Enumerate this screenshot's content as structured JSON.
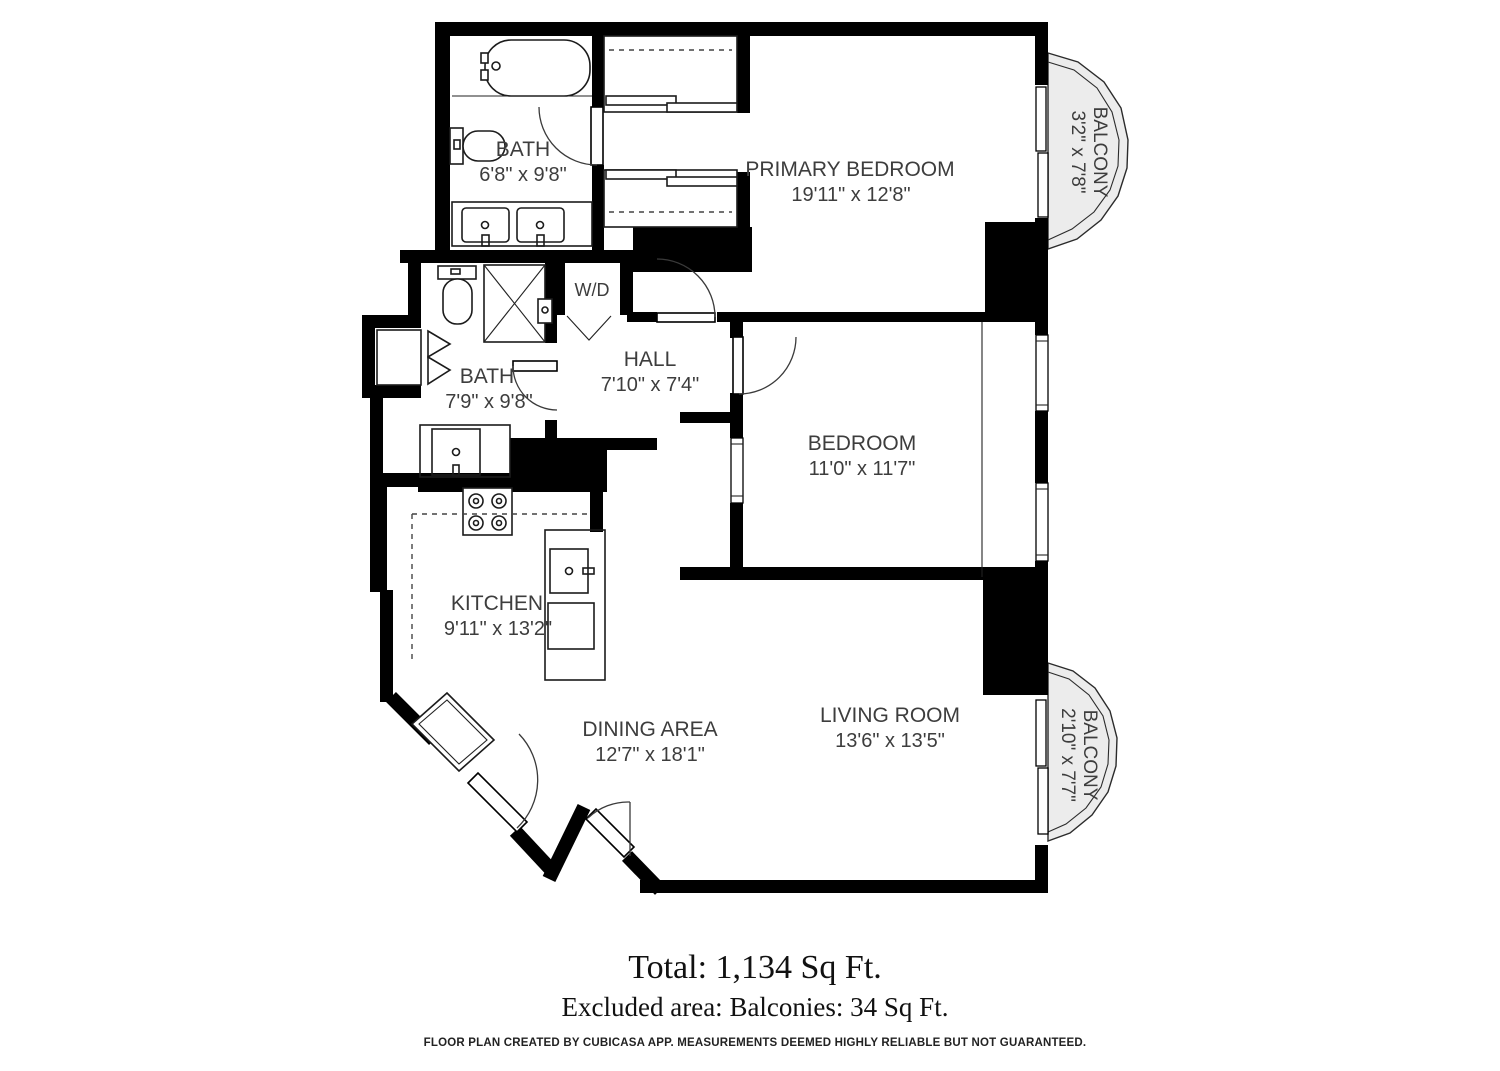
{
  "rooms": {
    "bath_top": {
      "name": "BATH",
      "dims": "6'8\" x 9'8\""
    },
    "primary_bedroom": {
      "name": "PRIMARY BEDROOM",
      "dims": "19'11\" x 12'8\""
    },
    "balcony_top": {
      "name": "BALCONY",
      "dims": "3'2\" x 7'8\""
    },
    "bath_mid": {
      "name": "BATH",
      "dims": "7'9\" x 9'8\""
    },
    "wd_closet": {
      "name": "W/D"
    },
    "hall": {
      "name": "HALL",
      "dims": "7'10\" x 7'4\""
    },
    "bedroom": {
      "name": "BEDROOM",
      "dims": "11'0\" x 11'7\""
    },
    "kitchen": {
      "name": "KITCHEN",
      "dims": "9'11\" x 13'2\""
    },
    "dining": {
      "name": "DINING AREA",
      "dims": "12'7\" x 18'1\""
    },
    "living": {
      "name": "LIVING ROOM",
      "dims": "13'6\" x 13'5\""
    },
    "balcony_bottom": {
      "name": "BALCONY",
      "dims": "2'10\" x 7'7\""
    }
  },
  "summary": {
    "total": "Total: 1,134 Sq Ft.",
    "excluded": "Excluded area: Balconies: 34 Sq Ft."
  },
  "footer": "FLOOR PLAN CREATED BY CUBICASA APP. MEASUREMENTS DEEMED HIGHLY RELIABLE BUT NOT GUARANTEED.",
  "colors": {
    "wall": "#000000",
    "balcony_fill": "#ececec",
    "label": "#3d3d3d"
  }
}
